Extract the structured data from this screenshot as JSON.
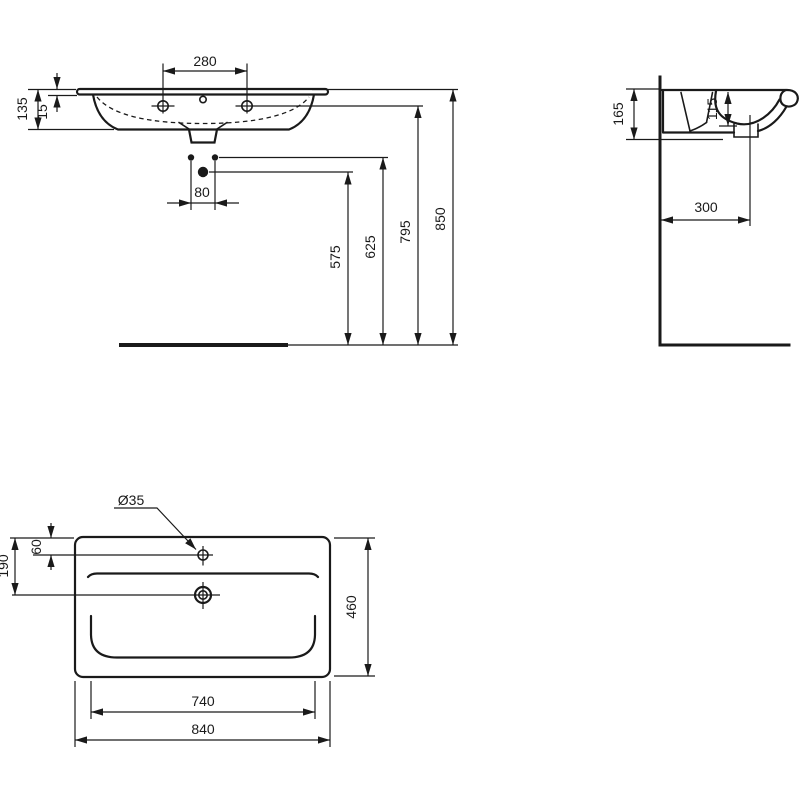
{
  "colors": {
    "ink": "#1a1a1a",
    "background": "#ffffff"
  },
  "front_view": {
    "tap_hole_spacing": "280",
    "basin_height": "135",
    "rim_thickness": "15",
    "fixing_hole_spacing": "80",
    "supply_height": "575",
    "fixing_hole_height": "625",
    "tap_deck_height": "795",
    "rim_height": "850"
  },
  "side_view": {
    "basin_depth": "165",
    "bowl_depth": "115",
    "drain_distance_from_wall": "300"
  },
  "plan_view": {
    "tap_hole_diameter": "Ø35",
    "tap_hole_offset": "60",
    "drain_offset": "190",
    "basin_total_depth": "460",
    "bowl_width": "740",
    "basin_total_width": "840"
  }
}
